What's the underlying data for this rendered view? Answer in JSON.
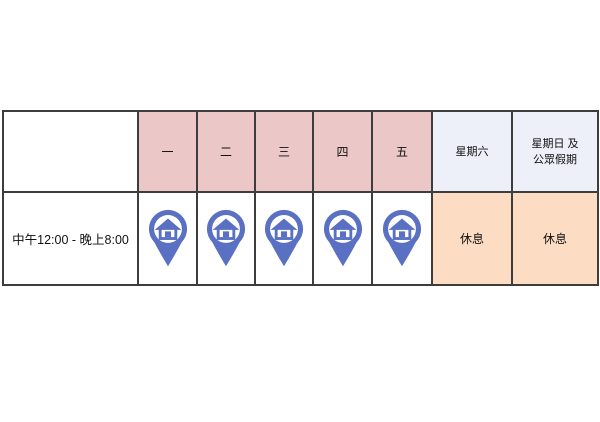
{
  "schedule_table": {
    "header": {
      "corner": "",
      "weekdays": [
        "一",
        "二",
        "三",
        "四",
        "五"
      ],
      "saturday": "星期六",
      "sunday_holiday_line1": "星期日 及",
      "sunday_holiday_line2": "公眾假期"
    },
    "body": {
      "time_range": "中午12:00 - 晚上8:00",
      "weekday_status_icon": "home-location-pin-icon",
      "saturday_status": "休息",
      "sunday_holiday_status": "休息"
    },
    "colors": {
      "weekday_header_bg": "#ecc7c7",
      "weekend_header_bg": "#edeff9",
      "closed_cell_bg": "#fcdcc3",
      "pin_blue": "#5a71c3",
      "border": "#3d3d3d",
      "text": "#111111",
      "page_bg": "#ffffff"
    }
  }
}
